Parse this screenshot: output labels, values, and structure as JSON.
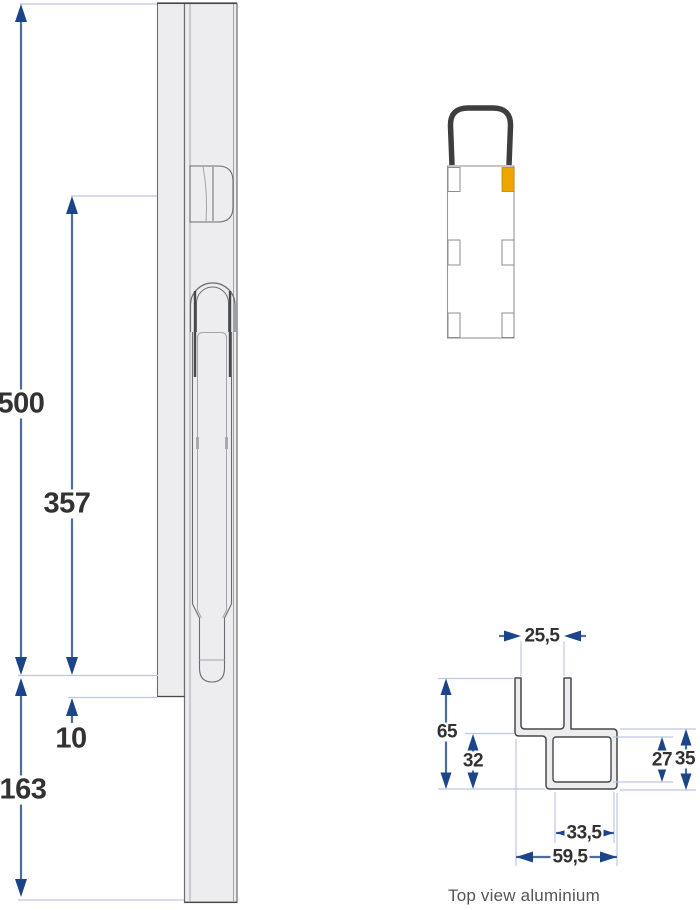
{
  "colors": {
    "dimension_line": "#4a6d9e",
    "arrowhead": "#1c4489",
    "extension_line": "#bdc7e2",
    "dim_text": "#323232",
    "caption_text": "#545559",
    "profile_fill": "#ededef",
    "profile_stroke": "#6b6c6f",
    "profile_stroke_dark": "#47484a",
    "profile_stroke_light": "#a3a4a8",
    "accent_orange": "#efa400",
    "bracket_dark": "#3d3e40"
  },
  "side_view": {
    "dim_total_length": "500",
    "dim_slot_length": "357",
    "dim_gap": "10",
    "dim_lower_section": "163"
  },
  "cross_section": {
    "caption": "Top view aluminium",
    "dim_channel_inner_width": "25,5",
    "dim_overall_depth": "65",
    "dim_lower_depth": "32",
    "dim_tube_inner_depth": "27",
    "dim_tube_outer_depth": "35",
    "dim_tube_inner_width": "33,5",
    "dim_overall_width": "59,5"
  }
}
